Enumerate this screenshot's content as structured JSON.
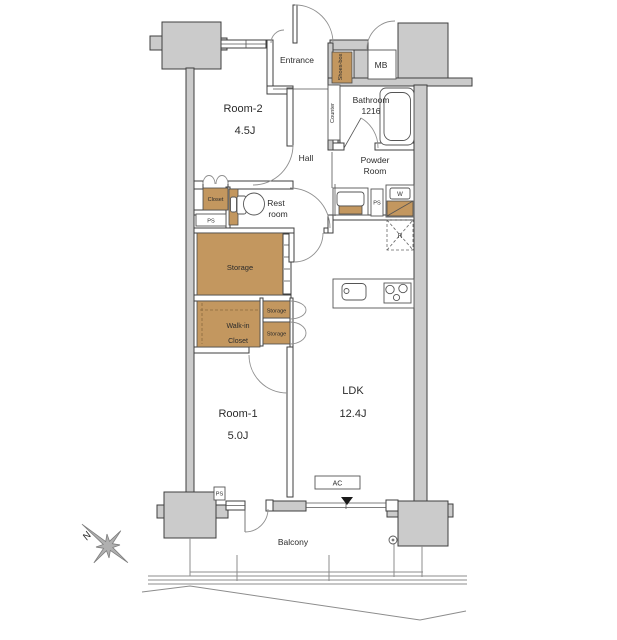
{
  "title": "Apartment floor plan",
  "colors": {
    "wood": "#c3975f",
    "wall_gray": "#cbcbcb",
    "outline": "#3f3f3f",
    "arc_gray": "#8f8f8f"
  },
  "rooms": {
    "room2": {
      "name": "Room-2",
      "area": "4.5J"
    },
    "room1": {
      "name": "Room-1",
      "area": "5.0J"
    },
    "ldk": {
      "name": "LDK",
      "area": "12.4J"
    },
    "entrance": {
      "name": "Entrance"
    },
    "hall": {
      "name": "Hall"
    },
    "powder_room": {
      "line1": "Powder",
      "line2": "Room"
    },
    "bathroom": {
      "name": "Bathroom",
      "size": "1216"
    },
    "restroom": {
      "line1": "Rest",
      "line2": "room"
    },
    "balcony": {
      "name": "Balcony"
    },
    "closet": {
      "name": "Closet"
    },
    "walk_in_closet": {
      "line1": "Walk-in",
      "line2": "Closet"
    },
    "storage_large": {
      "name": "Storage"
    },
    "storage_small_1": {
      "name": "Storage"
    },
    "storage_small_2": {
      "name": "Storage"
    }
  },
  "fixtures": {
    "shoes_box": "Shoes-box",
    "counter": "Counter",
    "meter_box": "MB",
    "pipe_space_1": "PS",
    "pipe_space_2": "PS",
    "pipe_space_3": "PS",
    "washing_machine": "W",
    "refrigerator": "R",
    "air_conditioner": "AC",
    "compass_north": "N"
  }
}
